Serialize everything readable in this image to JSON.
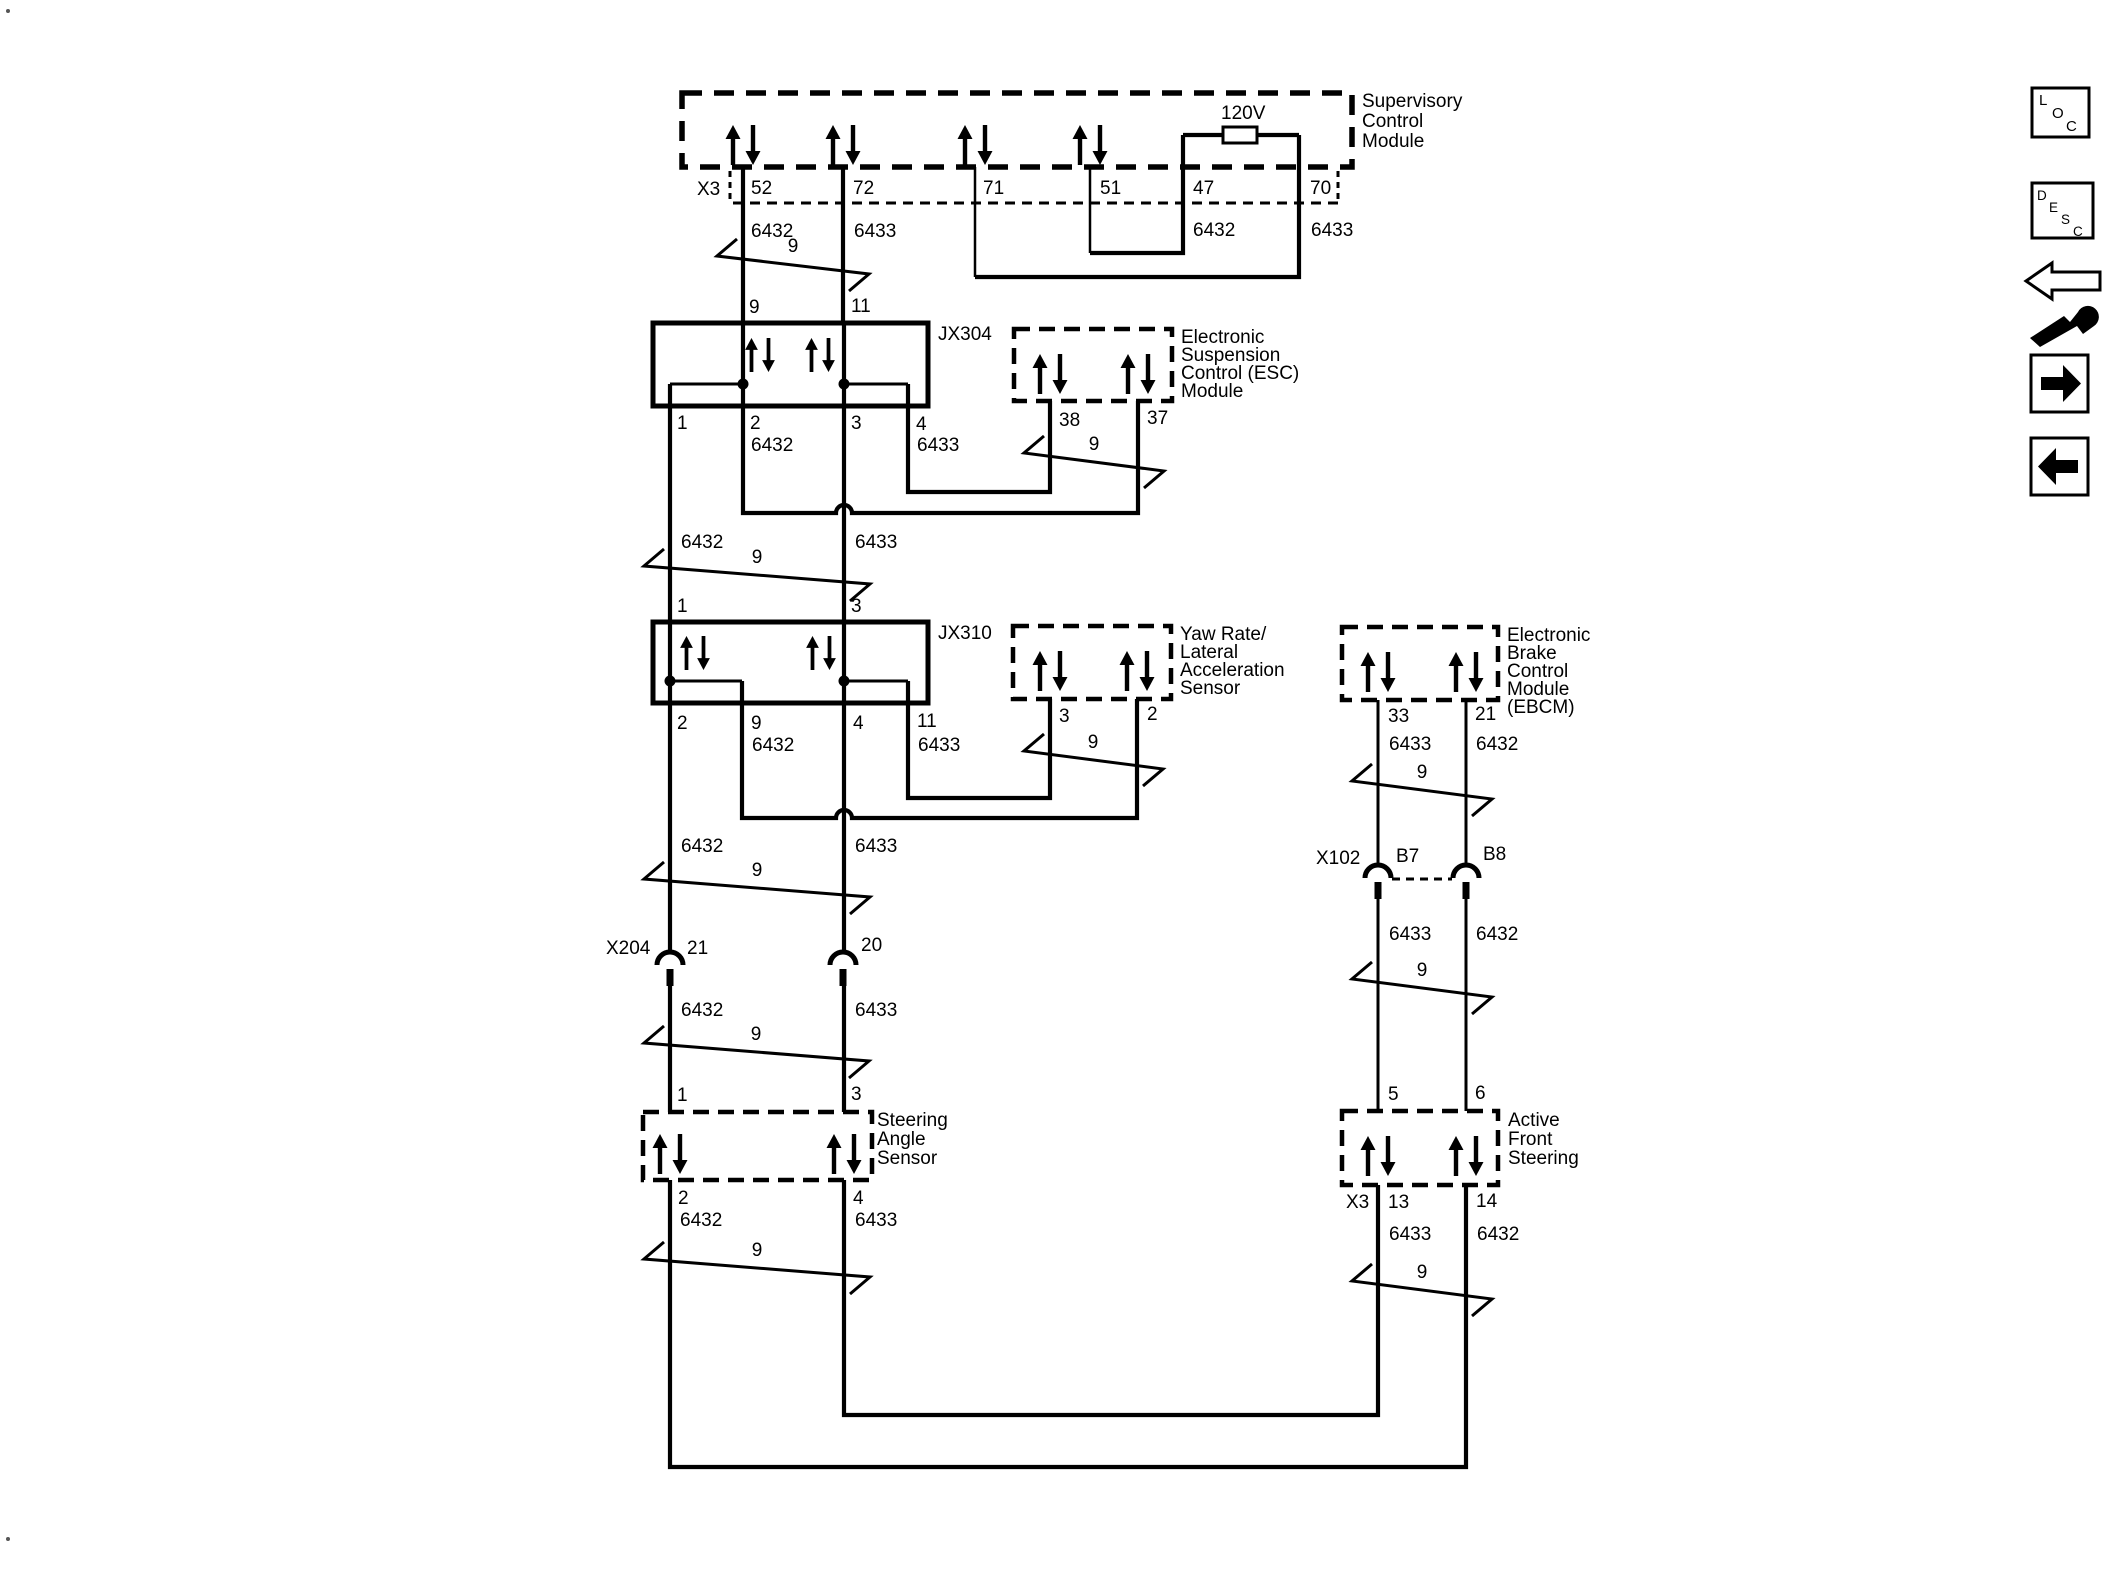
{
  "modules": {
    "supervisory": {
      "name": [
        "Supervisory",
        "Control",
        "Module"
      ],
      "connector_label": "X3",
      "resistor_label": "120V",
      "pins": [
        "52",
        "72",
        "71",
        "51",
        "47",
        "70"
      ],
      "wire_labels": [
        "6432",
        "6433",
        "6432",
        "6433"
      ]
    },
    "jx304": {
      "name": "JX304",
      "top_pins": [
        "9",
        "11"
      ],
      "bottom_pins": [
        "1",
        "2",
        "3",
        "4"
      ],
      "wire_labels": [
        "6432",
        "6433"
      ]
    },
    "esc": {
      "name": [
        "Electronic",
        "Suspension",
        "Control (ESC)",
        "Module"
      ],
      "pins": [
        "38",
        "37"
      ]
    },
    "jx310": {
      "name": "JX310",
      "top_pins": [
        "1",
        "3"
      ],
      "bottom_pins": [
        "2",
        "9",
        "4",
        "11"
      ],
      "wire_labels": [
        "6432",
        "6433"
      ]
    },
    "yaw_sensor": {
      "name": [
        "Yaw Rate/",
        "Lateral",
        "Acceleration",
        "Sensor"
      ],
      "pins": [
        "3",
        "2"
      ]
    },
    "ebcm": {
      "name": [
        "Electronic",
        "Brake",
        "Control",
        "Module",
        "(EBCM)"
      ],
      "pins": [
        "33",
        "21"
      ],
      "wire_labels": [
        "6433",
        "6432"
      ]
    },
    "steering_angle_sensor": {
      "name": [
        "Steering",
        "Angle",
        "Sensor"
      ],
      "top_pins": [
        "1",
        "3"
      ],
      "bottom_pins": [
        "2",
        "4"
      ],
      "wire_labels": [
        "6432",
        "6433"
      ]
    },
    "afs": {
      "name": [
        "Active",
        "Front",
        "Steering"
      ],
      "connector_label": "X3",
      "top_pins": [
        "5",
        "6"
      ],
      "bottom_pins": [
        "13",
        "14"
      ],
      "wire_labels": [
        "6433",
        "6432"
      ]
    }
  },
  "inline_connectors": {
    "x204": {
      "name": "X204",
      "pins": [
        "21",
        "20"
      ],
      "wire_labels_below": [
        "6432",
        "6433"
      ]
    },
    "x102": {
      "name": "X102",
      "pins": [
        "B7",
        "B8"
      ],
      "wire_labels_below": [
        "6433",
        "6432"
      ]
    }
  },
  "wires": {
    "between_jx304_jx310": [
      "6432",
      "6433"
    ],
    "below_jx310": [
      "6432",
      "6433"
    ],
    "twisted_pair_label": "9"
  },
  "toolbar": {
    "loc_letters": [
      "L",
      "O",
      "C"
    ],
    "desc_letters": [
      "D",
      "E",
      "S",
      "C"
    ]
  }
}
